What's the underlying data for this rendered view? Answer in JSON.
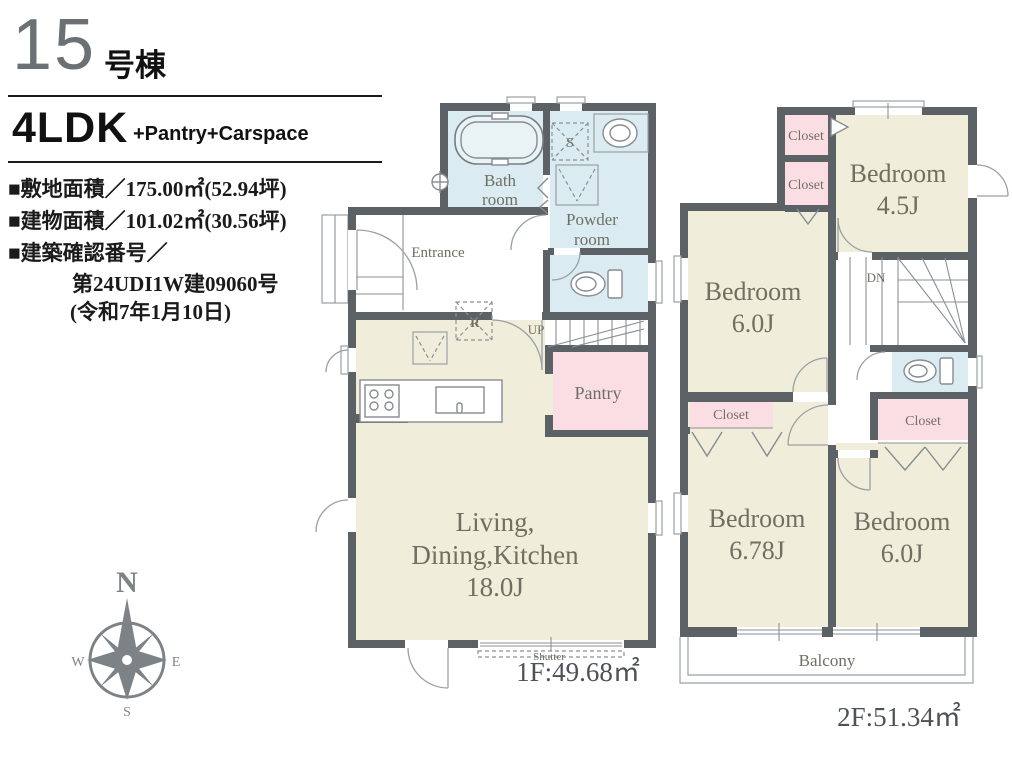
{
  "header": {
    "unit_number": "15",
    "unit_suffix": "号棟",
    "plan_type": "4LDK",
    "plan_extra": "+Pantry+Carspace",
    "specs": [
      "■敷地面積／175.00㎡(52.94坪)",
      "■建物面積／101.02㎡(30.56坪)",
      "■建築確認番号／",
      "第24UDI1W建09060号",
      "(令和7年1月10日)"
    ]
  },
  "compass": {
    "north": "N",
    "east": "E",
    "south": "S",
    "west": "W"
  },
  "floor1": {
    "area_label": "1F:49.68㎡",
    "rooms": {
      "bath_line1": "Bath",
      "bath_line2": "room",
      "powder_line1": "Powder",
      "powder_line2": "room",
      "entrance": "Entrance",
      "pantry": "Pantry",
      "ldk_line1": "Living,",
      "ldk_line2": "Dining,Kitchen",
      "ldk_size": "18.0J"
    },
    "labels": {
      "stairs": "UP",
      "shutter": "Shutter",
      "refrigerator": "R",
      "laundry": "S"
    }
  },
  "floor2": {
    "area_label": "2F:51.34㎡",
    "bedrooms": [
      {
        "name": "Bedroom",
        "size": "4.5J"
      },
      {
        "name": "Bedroom",
        "size": "6.0J"
      },
      {
        "name": "Bedroom",
        "size": "6.78J"
      },
      {
        "name": "Bedroom",
        "size": "6.0J"
      }
    ],
    "closet_label": "Closet",
    "balcony_label": "Balcony",
    "stairs_label": "DN"
  },
  "colors": {
    "wall": "#5c6166",
    "room_main": "#f0eedb",
    "room_wet": "#daecf2",
    "room_storage": "#fadee3",
    "label_text": "#6f6f62",
    "header_number_gray": "#6a7074"
  }
}
